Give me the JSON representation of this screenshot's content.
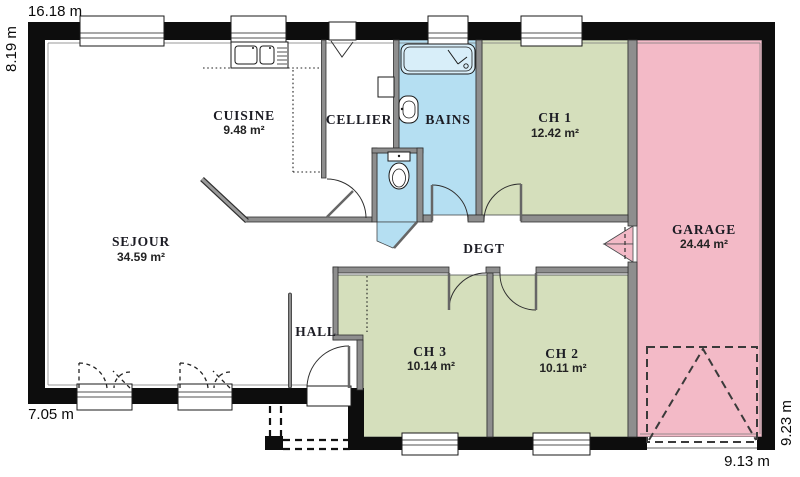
{
  "floorplan": {
    "rooms": [
      {
        "id": "cuisine",
        "name": "CUISINE",
        "area": "9.48 m²"
      },
      {
        "id": "cellier",
        "name": "CELLIER",
        "area": ""
      },
      {
        "id": "bains",
        "name": "BAINS",
        "area": ""
      },
      {
        "id": "ch1",
        "name": "CH 1",
        "area": "12.42 m²"
      },
      {
        "id": "garage",
        "name": "GARAGE",
        "area": "24.44 m²"
      },
      {
        "id": "sejour",
        "name": "SEJOUR",
        "area": "34.59 m²"
      },
      {
        "id": "degt",
        "name": "DEGT",
        "area": ""
      },
      {
        "id": "hall",
        "name": "HALL",
        "area": ""
      },
      {
        "id": "ch3",
        "name": "CH 3",
        "area": "10.14 m²"
      },
      {
        "id": "ch2",
        "name": "CH 2",
        "area": "10.11 m²"
      }
    ],
    "dimensions": {
      "top": "16.18 m",
      "left": "8.19 m",
      "bottom_left": "7.05 m",
      "right_side": "9.23 m",
      "bottom_right": "9.13 m"
    },
    "colors": {
      "bedroom": "#d5dfbc",
      "bath": "#b5dff2",
      "garage": "#f3bac7",
      "wall": "#0d0d0d"
    }
  }
}
